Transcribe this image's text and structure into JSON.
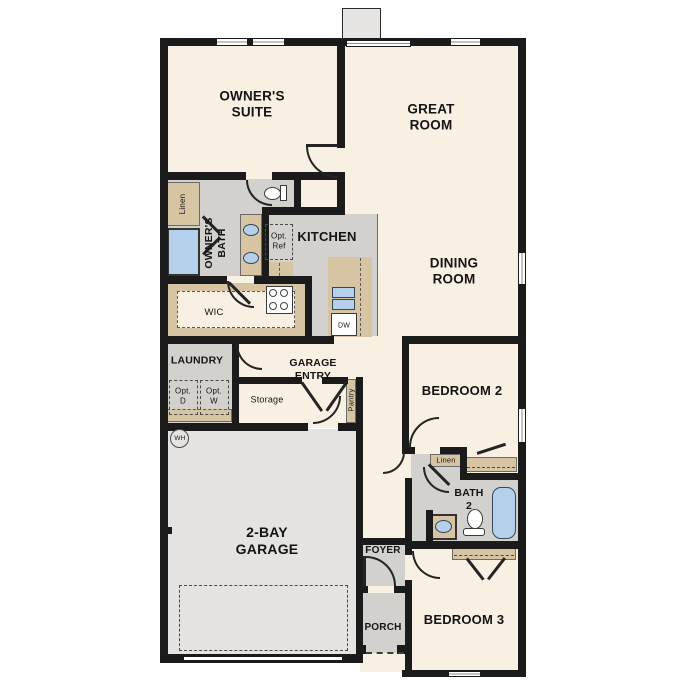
{
  "floorplan": {
    "rooms": {
      "owners_suite": "OWNER'S\nSUITE",
      "great_room": "GREAT\nROOM",
      "dining_room": "DINING\nROOM",
      "kitchen": "KITCHEN",
      "owners_bath": "OWNER'S\nBATH",
      "wic": "WIC",
      "laundry": "LAUNDRY",
      "garage_entry": "GARAGE\nENTRY",
      "storage": "Storage",
      "bedroom2": "BEDROOM 2",
      "bath2": "BATH\n2",
      "bedroom3": "BEDROOM 3",
      "foyer": "FOYER",
      "porch": "PORCH",
      "garage": "2-BAY\nGARAGE"
    },
    "closets": {
      "owners_linen": "Linen",
      "hall_linen": "Linen",
      "pantry": "Pantry"
    },
    "fixtures": {
      "opt_ref": "Opt.\nRef",
      "opt_dryer": "Opt.\nD",
      "opt_washer": "Opt.\nW",
      "dishwasher": "DW",
      "water_heater": "WH"
    },
    "colors": {
      "floor": "#f8f0e2",
      "wet_rooms": "#d2d1ce",
      "garage_floor": "#e4e3e1",
      "cabinetry": "#d6c4a3",
      "plumbing_fixtures": "#b4d0ea",
      "walls": "#1b1b1b"
    }
  }
}
